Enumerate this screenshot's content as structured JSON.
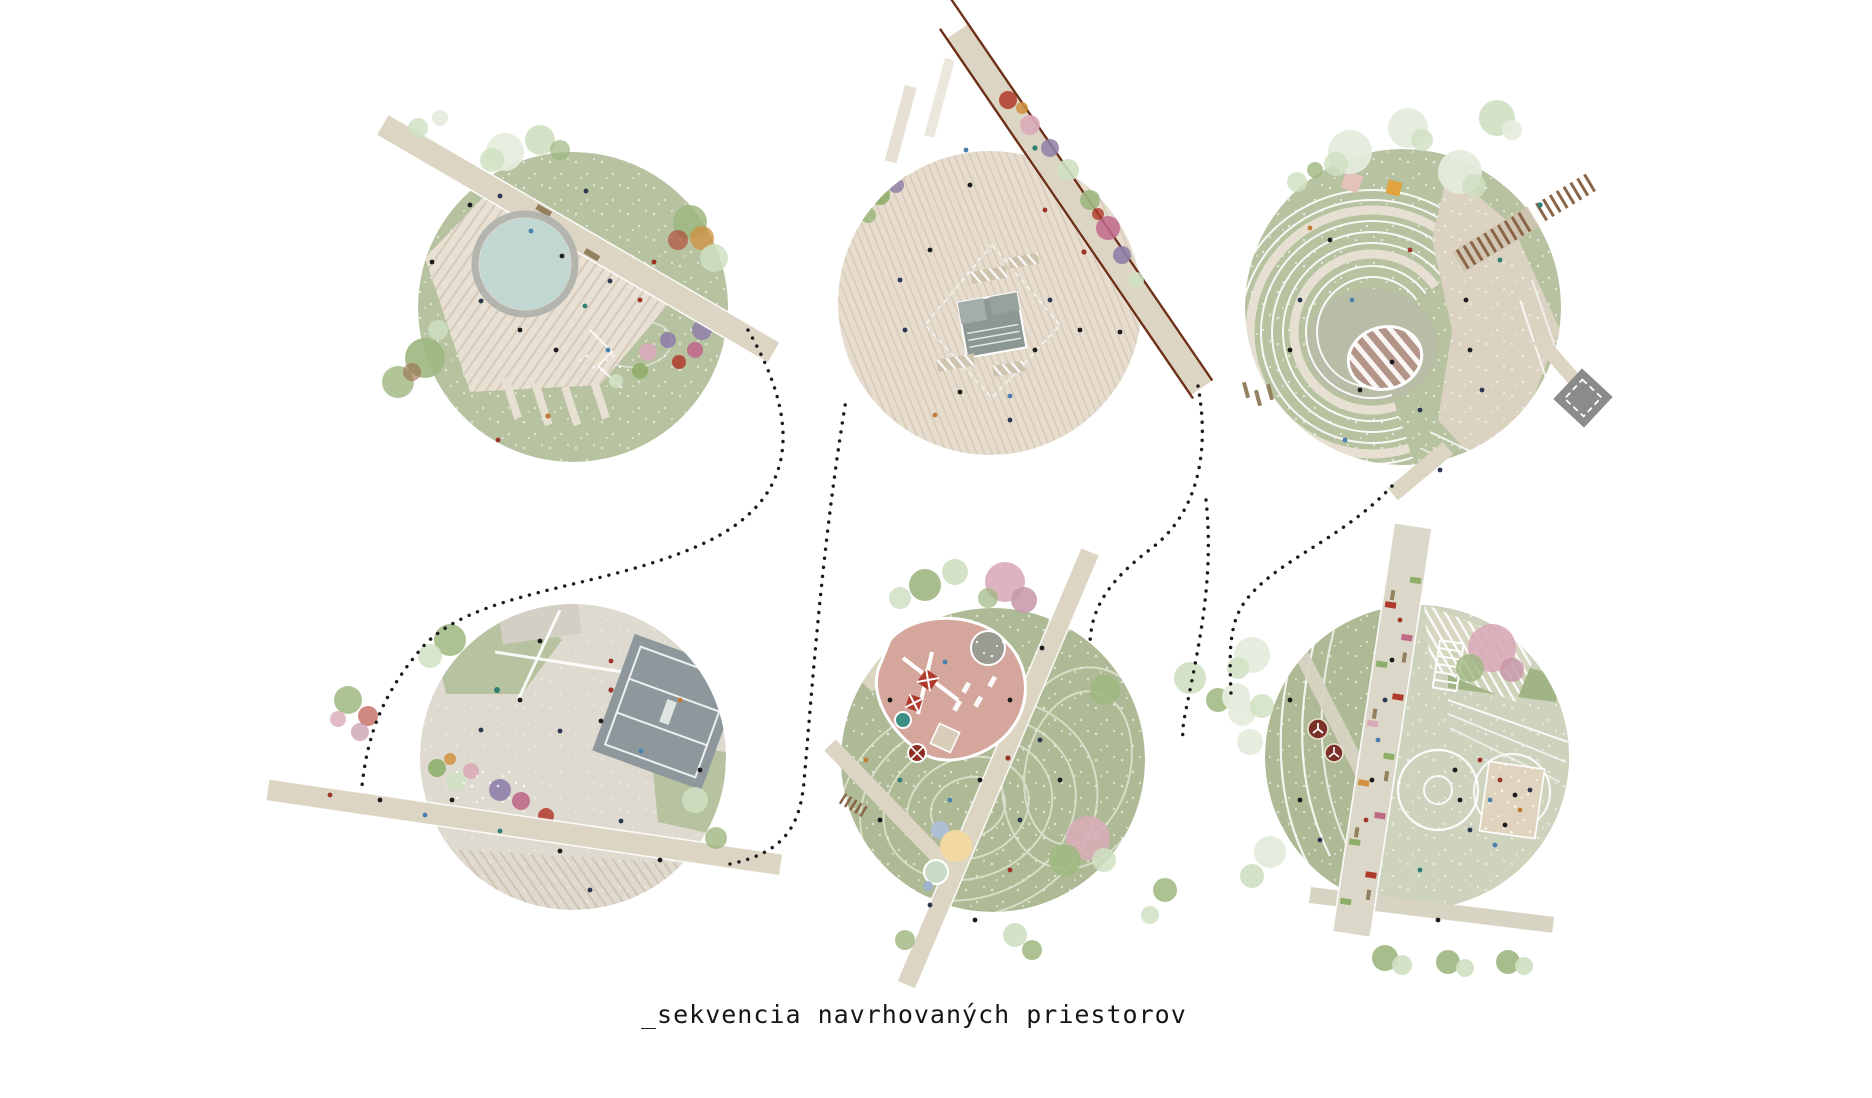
{
  "caption": {
    "text": "_sekvencia navrhovaných priestorov"
  },
  "palette": {
    "paper": "#ffffff",
    "ink": "#161616",
    "dotted": "#1b1b1b",
    "lawn": "#b6c2a0",
    "lawn2": "#aeba95",
    "plaza": "#dedacf",
    "deck": "#e8e0d3",
    "deckline": "#d7c9ba",
    "plazastripebase": "#e6ddcf",
    "plazastripeline": "#d8cbb9",
    "water": "#c3d7d2",
    "poolring": "#b4b4ae",
    "road": "#ddd5c4",
    "rail": "#6e3018",
    "court": "#8e979b",
    "graybox": "#8b8b89",
    "structure": "#8d9894",
    "ovalbrown": "#b29488",
    "playpink": "#d5a79c",
    "pebble": "#9b9b93",
    "sand": "#e0d4be",
    "pastelyellow": "#f2d9a2",
    "pastelblue": "#aebfd4",
    "pastelgreen": "#c9dcc6",
    "carousel": "#7c3128",
    "bench": "#93805f",
    "boardwalk": "#8a6548",
    "terrace": "#e7e0d2",
    "treegreen": "#9db77f",
    "treelight": "#cfe0c2",
    "treewhite": "#e4ecdc",
    "treepink": "#d9abb8",
    "treemauve": "#c695a8",
    "treepurple": "#8f7fa8",
    "flowerred": "#b03a2c",
    "flowermagenta": "#c06a8a",
    "flowerorange": "#d09040",
    "flowergreen": "#8fae6a",
    "peoplenavy": "#2c3850",
    "peopleblack": "#1d1d1d",
    "peoplered": "#9c3528",
    "peopleteal": "#2f7f74",
    "peopleorange": "#c07b35",
    "peopleblue": "#4a7fae"
  },
  "vignettes": [
    {
      "name": "pool-plaza"
    },
    {
      "name": "square-with-tram-stop"
    },
    {
      "name": "terraced-amphitheatre"
    },
    {
      "name": "event-plaza-with-court"
    },
    {
      "name": "playground-meadow"
    },
    {
      "name": "sports-promenade-park"
    }
  ]
}
